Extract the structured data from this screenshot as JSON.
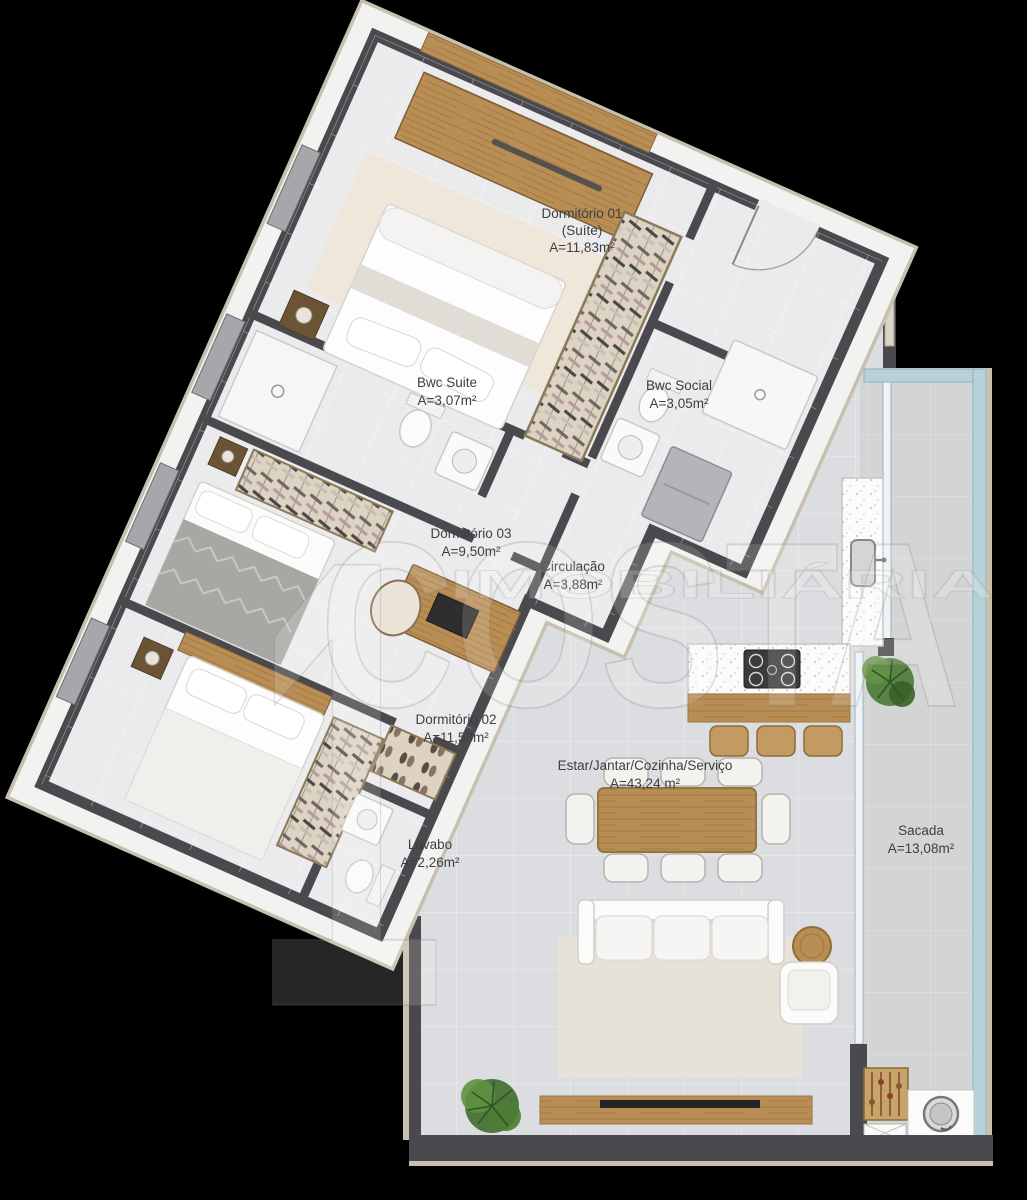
{
  "watermark": {
    "digit": "1",
    "brand": "COSTA",
    "tagline": "IMOBILIÁRIA"
  },
  "rooms": {
    "dormitorio_01": {
      "name": "Dormitório 01",
      "suffix": "(Suíte)",
      "area": "A=11,83m²"
    },
    "bwc_suite": {
      "name": "Bwc Suite",
      "area": "A=3,07m²"
    },
    "bwc_social": {
      "name": "Bwc Social",
      "area": "A=3,05m²"
    },
    "dormitorio_03": {
      "name": "Dormitório 03",
      "area": "A=9,50m²"
    },
    "circulacao": {
      "name": "Circulação",
      "area": "A=3,88m²"
    },
    "dormitorio_02": {
      "name": "Dormitório 02",
      "area": "A=11,53m²"
    },
    "lavabo": {
      "name": "Lavabo",
      "area": "A=2,26m²"
    },
    "estar_jantar_cozinha_servico": {
      "name": "Estar/Jantar/Cozinha/Serviço",
      "area": "A=43,24 m²"
    },
    "sacada": {
      "name": "Sacada",
      "area": "A=13,08m²"
    }
  },
  "colors": {
    "background": "#000000",
    "wall": "#4a4a4e",
    "outer_trim": "#c7c0ae",
    "floor_bedroom_wing": "#ebebed",
    "floor_living": "#dcdde0",
    "floor_balcony": "#d3d4d6",
    "wood": "#b98e55",
    "railing_teal": "#b6d1d8",
    "label_text": "#3e3e41"
  }
}
